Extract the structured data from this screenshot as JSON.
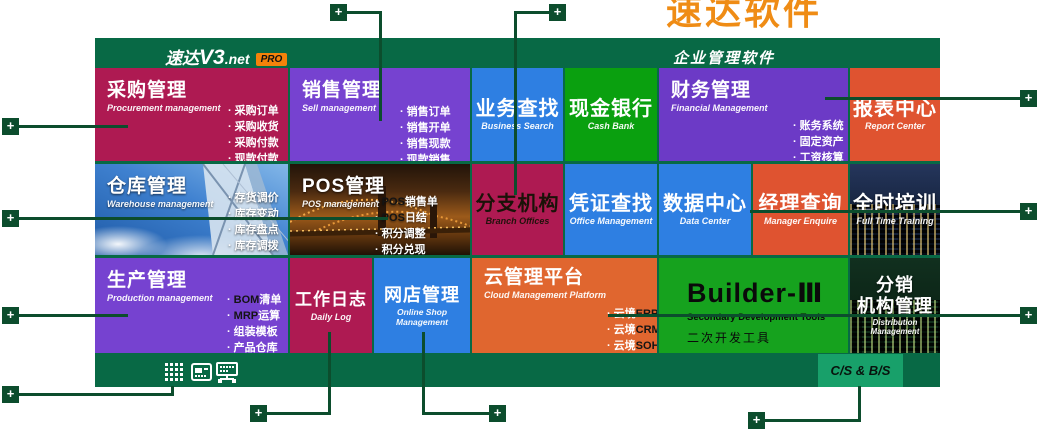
{
  "top_banner": {
    "text": "速达软件"
  },
  "header": {
    "brand_cn": "速达",
    "brand_version": "V3",
    "brand_suffix": ".net",
    "badge": "PRO",
    "title_right": "企业管理软件"
  },
  "tiles": {
    "procurement": {
      "title": "采购管理",
      "subtitle": "Procurement management",
      "bullets": [
        [
          {
            "t": "采购订单"
          }
        ],
        [
          {
            "t": "采购收货"
          }
        ],
        [
          {
            "t": "采购付款"
          }
        ],
        [
          {
            "t": "现款付款"
          }
        ]
      ]
    },
    "sales": {
      "title": "销售管理",
      "subtitle": "Sell management",
      "bullets": [
        [
          {
            "t": "销售订单"
          }
        ],
        [
          {
            "t": "销售开单"
          }
        ],
        [
          {
            "t": "销售现款"
          }
        ],
        [
          {
            "t": "现款销售"
          }
        ]
      ]
    },
    "business_search": {
      "title": "业务查找",
      "subtitle": "Business Search"
    },
    "cash_bank": {
      "title": "现金银行",
      "subtitle": "Cash Bank"
    },
    "finance": {
      "title": "财务管理",
      "subtitle": "Financial Management",
      "bullets": [
        [
          {
            "t": "账务系统"
          }
        ],
        [
          {
            "t": "固定资产"
          }
        ],
        [
          {
            "t": "工资核算"
          }
        ]
      ]
    },
    "report_center": {
      "title": "报表中心",
      "subtitle": "Report Center"
    },
    "warehouse": {
      "title": "仓库管理",
      "subtitle": "Warehouse management",
      "bullets": [
        [
          {
            "t": "存货调价"
          }
        ],
        [
          {
            "t": "库存变动"
          }
        ],
        [
          {
            "t": "库存盘点"
          }
        ],
        [
          {
            "t": "库存调拨"
          }
        ]
      ]
    },
    "pos": {
      "title": "POS管理",
      "subtitle": "POS management",
      "bullets": [
        [
          {
            "t": "POS",
            "dark": true
          },
          {
            "t": "销售单"
          }
        ],
        [
          {
            "t": "POS",
            "dark": true
          },
          {
            "t": "日结"
          }
        ],
        [
          {
            "t": "积分调整"
          }
        ],
        [
          {
            "t": "积分兑现"
          }
        ]
      ]
    },
    "branch_offices": {
      "title": "分支机构",
      "subtitle": "Branch Offices"
    },
    "voucher_search": {
      "title": "凭证查找",
      "subtitle": "Office Management"
    },
    "data_center": {
      "title": "数据中心",
      "subtitle": "Data Center"
    },
    "manager_enquire": {
      "title": "经理查询",
      "subtitle": "Manager Enquire"
    },
    "full_time_training": {
      "title": "全时培训",
      "subtitle": "Full Time Training"
    },
    "production": {
      "title": "生产管理",
      "subtitle": "Production management",
      "bullets": [
        [
          {
            "t": "BOM",
            "dark": true
          },
          {
            "t": "清单"
          }
        ],
        [
          {
            "t": "MRP",
            "dark": true
          },
          {
            "t": "运算"
          }
        ],
        [
          {
            "t": "组装模板"
          }
        ],
        [
          {
            "t": "产品仓库"
          }
        ]
      ]
    },
    "daily_log": {
      "title": "工作日志",
      "subtitle": "Daily Log"
    },
    "online_shop": {
      "title": "网店管理",
      "subtitle": "Online Shop Management"
    },
    "cloud_platform": {
      "title": "云管理平台",
      "subtitle": "Cloud Management Platform",
      "bullets": [
        [
          {
            "t": "云境"
          },
          {
            "t": "ERP",
            "dark": true
          }
        ],
        [
          {
            "t": "云境"
          },
          {
            "t": "CRM",
            "dark": true
          }
        ],
        [
          {
            "t": "云境"
          },
          {
            "t": "SOHO",
            "dark": true
          }
        ]
      ]
    },
    "builder": {
      "title": "Builder-Ⅲ",
      "subtitle": "Secondary Development Tools",
      "caption": "二次开发工具"
    },
    "distribution": {
      "title_line1": "分销",
      "title_line2": "机构管理",
      "subtitle": "Distribution Management"
    }
  },
  "footer": {
    "cs_bs_label": "C/S & B/S",
    "icons": [
      "app-grid-icon",
      "report-window-icon",
      "network-monitor-icon"
    ]
  },
  "callouts": {
    "plus_label": "+"
  },
  "colors": {
    "panel_green": "#086945",
    "callout_green": "#0C4D2D",
    "crimson": "#AE1A52",
    "purple": "#7642D0",
    "purple_deep": "#6C3AC6",
    "blue": "#2E7FE2",
    "green_bright": "#0AA00F",
    "builder_green": "#16A21E",
    "orange_red": "#DF5330",
    "orange": "#E0662F",
    "cs_green": "#18A06A",
    "badge_orange": "#F5820A",
    "banner_orange": "#EF8C15"
  }
}
